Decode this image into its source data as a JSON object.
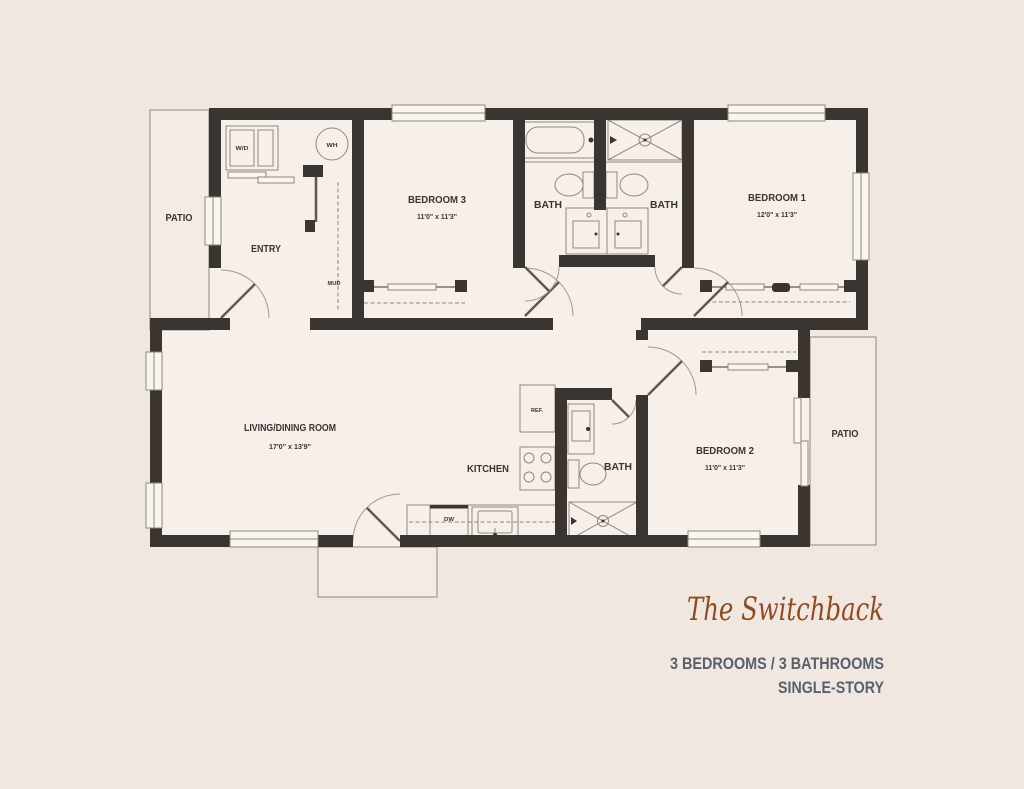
{
  "title": "The Switchback",
  "subtitle": {
    "stats_line": "3 BEDROOMS / 3 BATHROOMS",
    "story_line": "SINGLE-STORY"
  },
  "rooms": {
    "patio_left": {
      "name": "PATIO"
    },
    "entry": {
      "name": "ENTRY"
    },
    "bedroom3": {
      "name": "BEDROOM 3",
      "dims": "11'0\" x 11'3\""
    },
    "bath1": {
      "name": "BATH"
    },
    "bath2": {
      "name": "BATH"
    },
    "bedroom1": {
      "name": "BEDROOM 1",
      "dims": "12'0\" x 11'3\""
    },
    "living_dining": {
      "name": "LIVING/DINING ROOM",
      "dims": "17'0\" x 13'9\""
    },
    "kitchen": {
      "name": "KITCHEN"
    },
    "bath3": {
      "name": "BATH"
    },
    "bedroom2": {
      "name": "BEDROOM 2",
      "dims": "11'0\" x 11'3\""
    },
    "patio_right": {
      "name": "PATIO"
    }
  },
  "fixtures": {
    "washer_dryer": "W/D",
    "water_heater": "WH",
    "mud_room": "MUD",
    "refrigerator": "REF.",
    "dishwasher": "DW"
  },
  "colors": {
    "background": "#f0e7e1",
    "floor": "#f7efe9",
    "wall": "#3a3531",
    "thin_line": "#8e8881",
    "accent_title": "#8e4c22",
    "subtitle_text": "#57616b"
  }
}
